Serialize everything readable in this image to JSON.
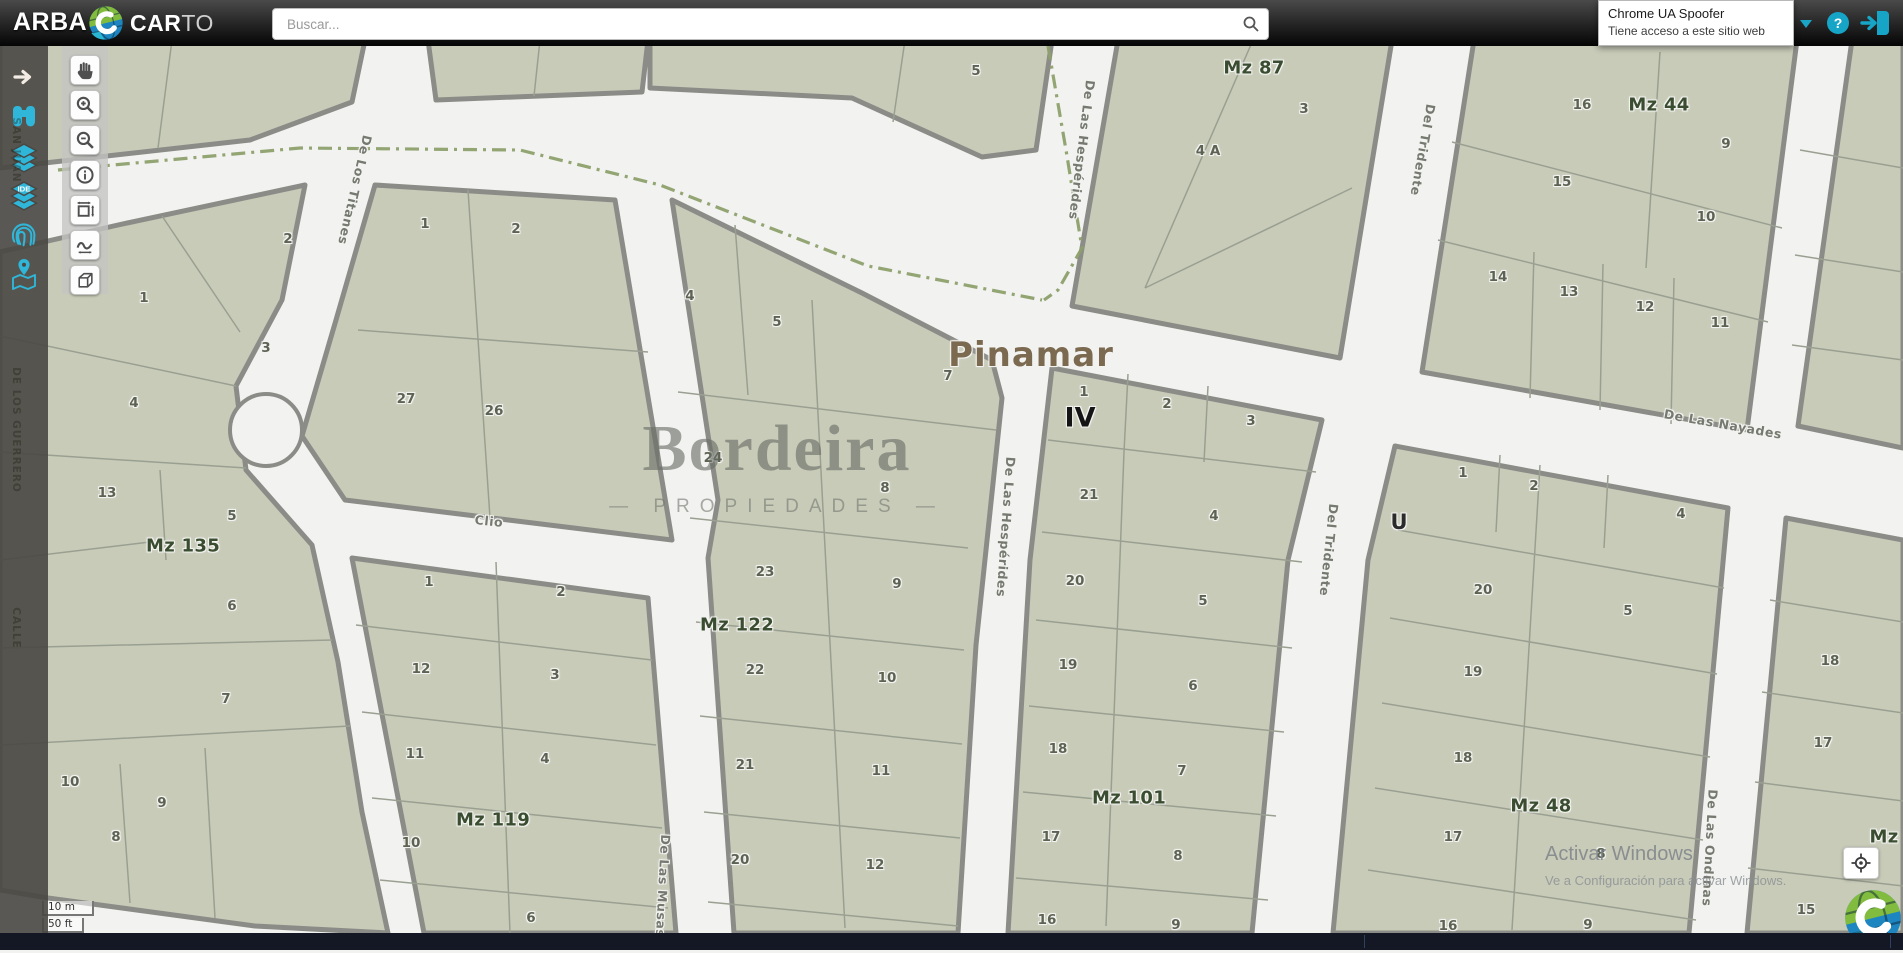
{
  "topbar": {
    "brand": "ARBA",
    "logo_bold": "CAR",
    "logo_light": "TO",
    "search": {
      "placeholder": "Buscar..."
    },
    "tooltip": {
      "title": "Chrome UA Spoofer",
      "subtitle": "Tiene acceso a este sitio web"
    },
    "help_label": "?"
  },
  "sidebar": {
    "ide_label": "IDE",
    "items": [
      {
        "name": "collapse-arrow"
      },
      {
        "name": "binoculars-search"
      },
      {
        "name": "layers"
      },
      {
        "name": "ide-layers"
      },
      {
        "name": "fingerprint"
      },
      {
        "name": "map-location"
      }
    ]
  },
  "toolbar": {
    "buttons": [
      "pan-hand",
      "zoom-in",
      "zoom-out",
      "info",
      "measure-area",
      "measure-line",
      "box-3d"
    ]
  },
  "map": {
    "city_label": "Pinamar",
    "section_label": "IV",
    "zone_label": "U",
    "watermark": {
      "title": "Bordeira",
      "subtitle": "— PROPIEDADES —"
    },
    "scale": {
      "metric": "10 m",
      "imperial": "50 ft"
    },
    "windows": {
      "line1": "Activar Windows",
      "line2": "Ve a Configuración para activar Windows."
    },
    "mz_labels": [
      {
        "t": "Mz 87",
        "x": 1254,
        "y": 68
      },
      {
        "t": "Mz 44",
        "x": 1659,
        "y": 105
      },
      {
        "t": "Mz 135",
        "x": 183,
        "y": 546
      },
      {
        "t": "Mz 122",
        "x": 737,
        "y": 625
      },
      {
        "t": "Mz 119",
        "x": 493,
        "y": 820
      },
      {
        "t": "Mz 101",
        "x": 1129,
        "y": 798
      },
      {
        "t": "Mz 48",
        "x": 1541,
        "y": 806
      },
      {
        "t": "Mz",
        "x": 1884,
        "y": 837
      }
    ],
    "street_labels": [
      {
        "t": "De Los Titanes",
        "x": 355,
        "y": 190,
        "r": 103
      },
      {
        "t": "De Las Hespérides",
        "x": 1082,
        "y": 150,
        "r": 97
      },
      {
        "t": "De Las Hespérides",
        "x": 1006,
        "y": 527,
        "r": 94
      },
      {
        "t": "Del Tridente",
        "x": 1423,
        "y": 150,
        "r": 100
      },
      {
        "t": "Del Tridente",
        "x": 1329,
        "y": 550,
        "r": 96
      },
      {
        "t": "De Las Nayades",
        "x": 1723,
        "y": 424,
        "r": 10
      },
      {
        "t": "Clio",
        "x": 489,
        "y": 521,
        "r": 6
      },
      {
        "t": "De Las Musas",
        "x": 663,
        "y": 886,
        "r": 93
      },
      {
        "t": "De Las Ondinas",
        "x": 1710,
        "y": 848,
        "r": 93
      }
    ],
    "hidden_street_labels": [
      {
        "t": "SAN JUAN",
        "x": 16,
        "y": 150
      },
      {
        "t": "DE LOS GUERRERO",
        "x": 16,
        "y": 430
      },
      {
        "t": "CALLE",
        "x": 16,
        "y": 628
      }
    ],
    "parcels": [
      {
        "t": "2",
        "x": 288,
        "y": 239
      },
      {
        "t": "1",
        "x": 144,
        "y": 298
      },
      {
        "t": "3",
        "x": 266,
        "y": 348
      },
      {
        "t": "4",
        "x": 134,
        "y": 403
      },
      {
        "t": "13",
        "x": 107,
        "y": 493
      },
      {
        "t": "5",
        "x": 232,
        "y": 516
      },
      {
        "t": "6",
        "x": 232,
        "y": 606
      },
      {
        "t": "7",
        "x": 226,
        "y": 699
      },
      {
        "t": "10",
        "x": 70,
        "y": 782
      },
      {
        "t": "9",
        "x": 162,
        "y": 803
      },
      {
        "t": "8",
        "x": 116,
        "y": 837
      },
      {
        "t": "1",
        "x": 425,
        "y": 224
      },
      {
        "t": "2",
        "x": 516,
        "y": 229
      },
      {
        "t": "27",
        "x": 406,
        "y": 399
      },
      {
        "t": "26",
        "x": 494,
        "y": 411
      },
      {
        "t": "5",
        "x": 976,
        "y": 71
      },
      {
        "t": "1",
        "x": 429,
        "y": 582
      },
      {
        "t": "2",
        "x": 561,
        "y": 592
      },
      {
        "t": "12",
        "x": 421,
        "y": 669
      },
      {
        "t": "3",
        "x": 555,
        "y": 675
      },
      {
        "t": "11",
        "x": 415,
        "y": 754
      },
      {
        "t": "4",
        "x": 545,
        "y": 759
      },
      {
        "t": "10",
        "x": 411,
        "y": 843
      },
      {
        "t": "6",
        "x": 531,
        "y": 918
      },
      {
        "t": "4",
        "x": 690,
        "y": 296
      },
      {
        "t": "5",
        "x": 777,
        "y": 322
      },
      {
        "t": "7",
        "x": 948,
        "y": 376
      },
      {
        "t": "24",
        "x": 713,
        "y": 458
      },
      {
        "t": "8",
        "x": 885,
        "y": 488
      },
      {
        "t": "23",
        "x": 765,
        "y": 572
      },
      {
        "t": "9",
        "x": 897,
        "y": 584
      },
      {
        "t": "22",
        "x": 755,
        "y": 670
      },
      {
        "t": "10",
        "x": 887,
        "y": 678
      },
      {
        "t": "21",
        "x": 745,
        "y": 765
      },
      {
        "t": "11",
        "x": 881,
        "y": 771
      },
      {
        "t": "20",
        "x": 740,
        "y": 860
      },
      {
        "t": "12",
        "x": 875,
        "y": 865
      },
      {
        "t": "3",
        "x": 1304,
        "y": 109
      },
      {
        "t": "4 A",
        "x": 1208,
        "y": 151
      },
      {
        "t": "16",
        "x": 1582,
        "y": 105
      },
      {
        "t": "9",
        "x": 1726,
        "y": 144
      },
      {
        "t": "15",
        "x": 1562,
        "y": 182
      },
      {
        "t": "10",
        "x": 1706,
        "y": 217
      },
      {
        "t": "14",
        "x": 1498,
        "y": 277
      },
      {
        "t": "13",
        "x": 1569,
        "y": 292
      },
      {
        "t": "12",
        "x": 1645,
        "y": 307
      },
      {
        "t": "11",
        "x": 1720,
        "y": 323
      },
      {
        "t": "1",
        "x": 1084,
        "y": 392
      },
      {
        "t": "2",
        "x": 1167,
        "y": 404
      },
      {
        "t": "3",
        "x": 1251,
        "y": 421
      },
      {
        "t": "21",
        "x": 1089,
        "y": 495
      },
      {
        "t": "4",
        "x": 1214,
        "y": 516
      },
      {
        "t": "20",
        "x": 1075,
        "y": 581
      },
      {
        "t": "5",
        "x": 1203,
        "y": 601
      },
      {
        "t": "19",
        "x": 1068,
        "y": 665
      },
      {
        "t": "6",
        "x": 1193,
        "y": 686
      },
      {
        "t": "18",
        "x": 1058,
        "y": 749
      },
      {
        "t": "7",
        "x": 1182,
        "y": 771
      },
      {
        "t": "17",
        "x": 1051,
        "y": 837
      },
      {
        "t": "8",
        "x": 1178,
        "y": 856
      },
      {
        "t": "16",
        "x": 1047,
        "y": 920
      },
      {
        "t": "9",
        "x": 1176,
        "y": 925
      },
      {
        "t": "1",
        "x": 1463,
        "y": 473
      },
      {
        "t": "2",
        "x": 1534,
        "y": 486
      },
      {
        "t": "4",
        "x": 1681,
        "y": 514
      },
      {
        "t": "20",
        "x": 1483,
        "y": 590
      },
      {
        "t": "5",
        "x": 1628,
        "y": 611
      },
      {
        "t": "19",
        "x": 1473,
        "y": 672
      },
      {
        "t": "18",
        "x": 1463,
        "y": 758
      },
      {
        "t": "17",
        "x": 1453,
        "y": 837
      },
      {
        "t": "8",
        "x": 1601,
        "y": 854
      },
      {
        "t": "16",
        "x": 1448,
        "y": 926
      },
      {
        "t": "9",
        "x": 1588,
        "y": 925
      },
      {
        "t": "18",
        "x": 1830,
        "y": 661
      },
      {
        "t": "17",
        "x": 1823,
        "y": 743
      },
      {
        "t": "15",
        "x": 1806,
        "y": 910
      }
    ]
  },
  "colors": {
    "accent_teal": "#2fb6d9",
    "parcel_fill": "#c8cbb8",
    "street_bg": "#f2f2f0",
    "block_border": "#8b8c87",
    "mz_green": "#3a4d30",
    "city_brown": "#7b6950",
    "boundary_dash": "#8da06b"
  }
}
